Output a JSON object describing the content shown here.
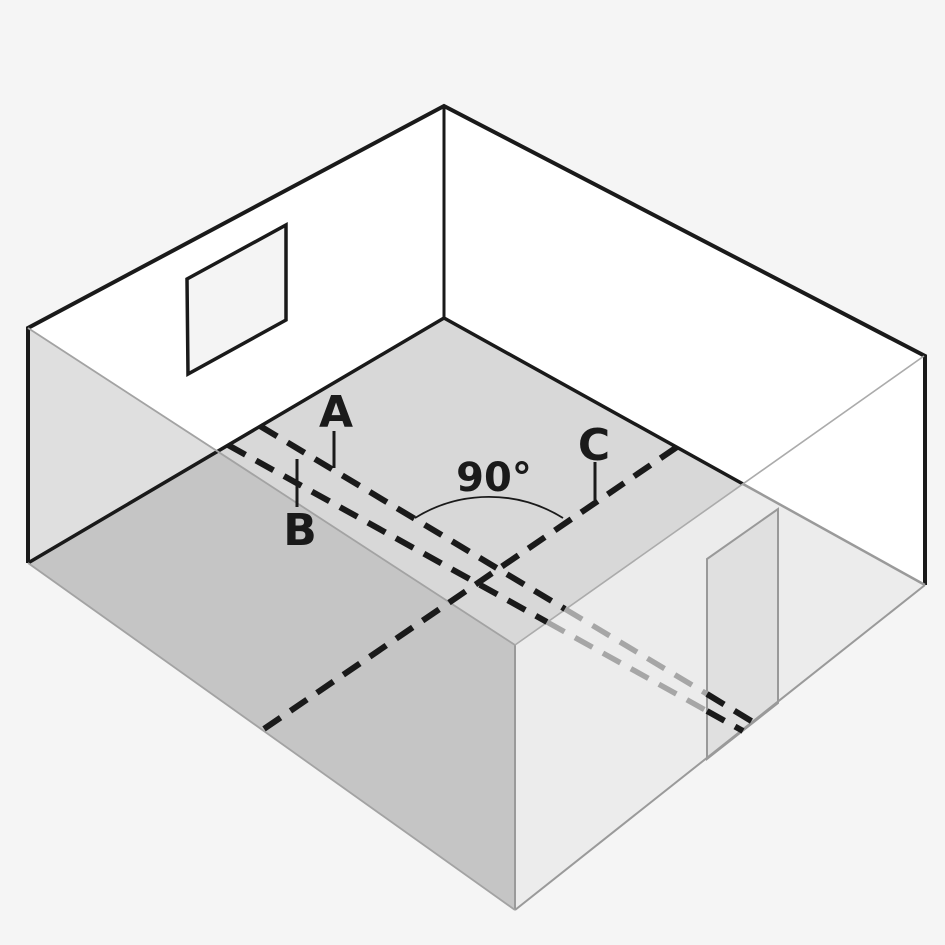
{
  "figure": {
    "description": "Isometric cutaway view of a room with a window in the back-left wall, an open door in the front-right wall, and dashed rays on the floor: parallel rays A and B crossed by ray C at a right angle, exiting through the door opening",
    "labels": {
      "ray_a": "A",
      "ray_b": "B",
      "ray_c": "C",
      "angle": "90°"
    },
    "colors": {
      "background": "#f5f5f5",
      "wall_interior": "#ffffff",
      "window": "#f4f4f4",
      "floor": "#d8d8d8",
      "front_left_wall_tint": "#dfdfdf",
      "front_left_wall_face": "#c5c5c5",
      "front_right_wall_face": "#ececec",
      "door_opening": "#e0e0e0",
      "outline": "#1a1a1a",
      "hidden_line": "#a6a6a6"
    }
  }
}
